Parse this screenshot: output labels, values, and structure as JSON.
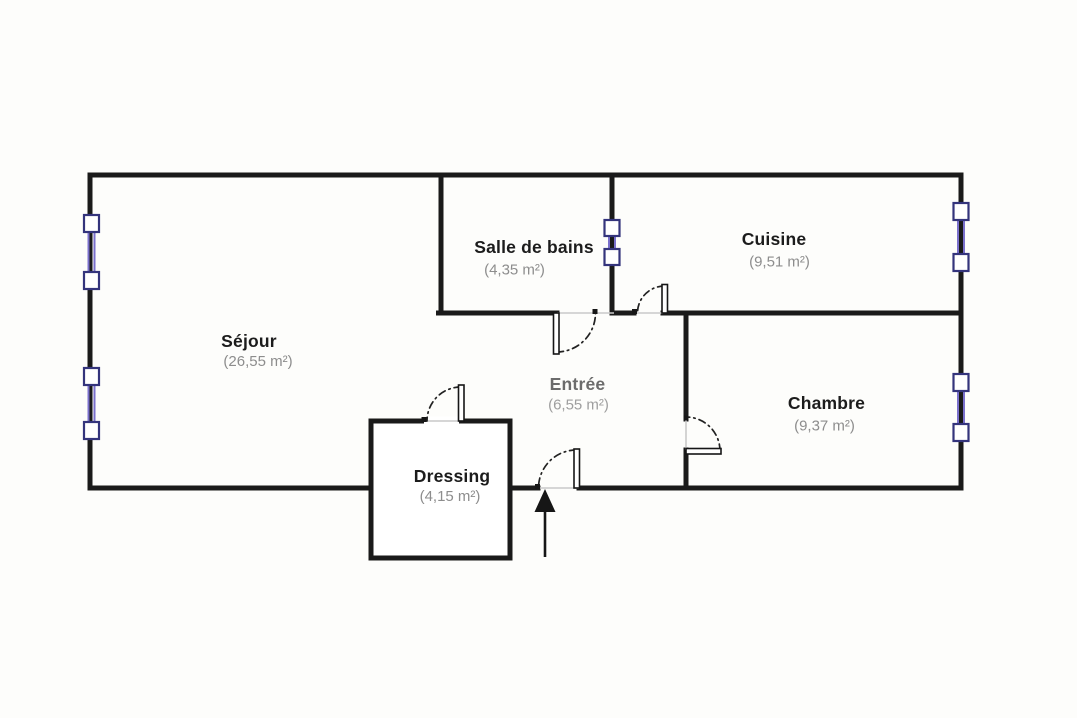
{
  "plan": {
    "title": "Plan d'appartement 2 pièces",
    "rooms": [
      {
        "id": "sejour",
        "name": "Séjour",
        "area": "(26,55 m²)"
      },
      {
        "id": "salle-de-bains",
        "name": "Salle de bains",
        "area": "(4,35 m²)"
      },
      {
        "id": "cuisine",
        "name": "Cuisine",
        "area": "(9,51 m²)"
      },
      {
        "id": "entree",
        "name": "Entrée",
        "area": "(6,55 m²)"
      },
      {
        "id": "chambre",
        "name": "Chambre",
        "area": "(9,37 m²)"
      },
      {
        "id": "dressing",
        "name": "Dressing",
        "area": "(4,15 m²)"
      }
    ],
    "colors": {
      "wall": "#1a1a1a",
      "room_name_text": "#1c1c1c",
      "room_area_text": "#8d8d8d",
      "entree_name_text": "#6c6c6c",
      "entree_area_text": "#9e9e9e",
      "window_frame": "#34347c",
      "window_glass": "#7a70cc",
      "opening_line": "#c9c9c9"
    },
    "counts": {
      "windows_exterior": 4,
      "windows_interior": 1,
      "doors": 5
    }
  }
}
